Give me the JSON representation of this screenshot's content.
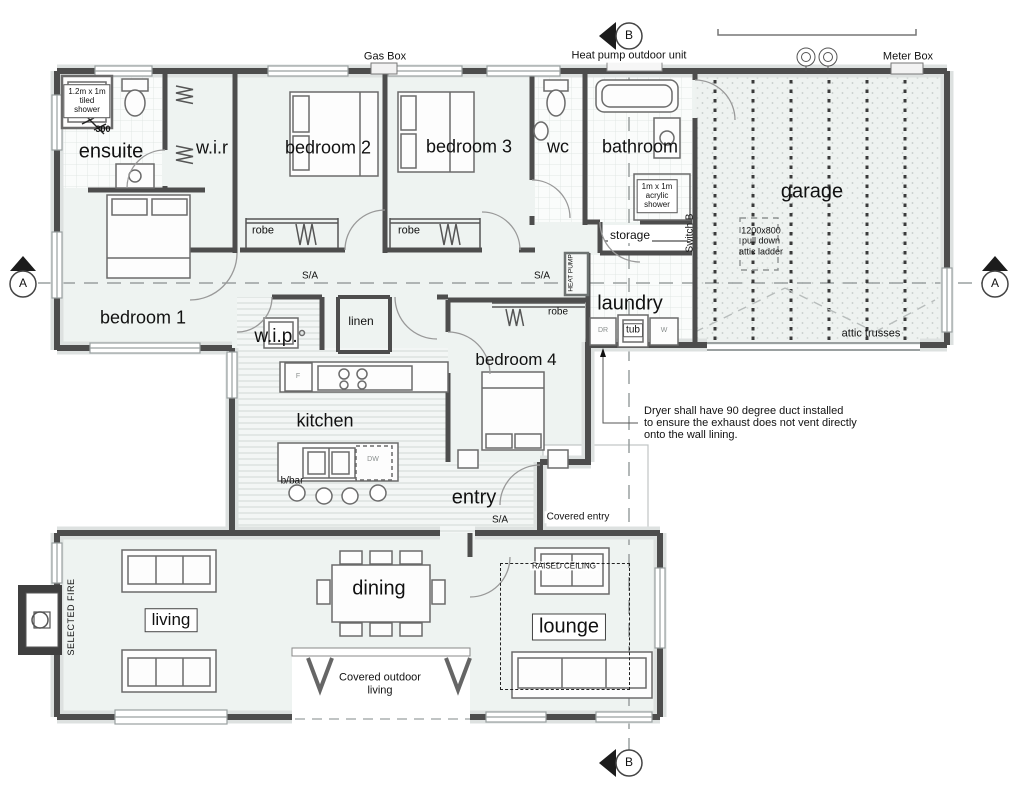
{
  "markers": {
    "a": "A",
    "b": "B"
  },
  "rooms": {
    "ensuite": "ensuite",
    "wir": "w.i.r",
    "bedroom1": "bedroom 1",
    "bedroom2": "bedroom 2",
    "bedroom3": "bedroom 3",
    "bedroom4": "bedroom 4",
    "wc": "wc",
    "bathroom": "bathroom",
    "storage": "storage",
    "laundry": "laundry",
    "garage": "garage",
    "wip": "w.i.p.",
    "linen": "linen",
    "kitchen": "kitchen",
    "entry": "entry",
    "living": "living",
    "dining": "dining",
    "lounge": "lounge"
  },
  "annotations": {
    "tiled_shower": "1.2m x 1m\ntiled\nshower",
    "dim_300": "300",
    "robe": "robe",
    "sa": "S/A",
    "gas_box": "Gas Box",
    "heat_pump_outdoor_unit": "Heat pump outdoor unit",
    "meter_box": "Meter Box",
    "acrylic_shower": "1m x 1m\nacrylic\nshower",
    "switch_b": "Switch B",
    "attic_ladder": "1200x800\npull down\nattic ladder",
    "attic_trusses": "attic trusses",
    "heat_pump": "HEAT PUMP",
    "dr": "DR",
    "tub": "tub",
    "w": "W",
    "dryer_note": "Dryer shall have 90 degree duct installed\nto ensure the exhaust does not vent directly\nonto the wall lining.",
    "covered_entry": "Covered entry",
    "bbar": "b/bar",
    "dw": "DW",
    "fridge": "F",
    "selected_fire": "SELECTED FIRE",
    "raised_ceiling": "RAISED CEILING",
    "covered_outdoor_living": "Covered outdoor\nliving"
  },
  "colors": {
    "wall": "#4d4d4d",
    "floor": "#eef3f1",
    "line_gray": "#9aa0a0"
  }
}
